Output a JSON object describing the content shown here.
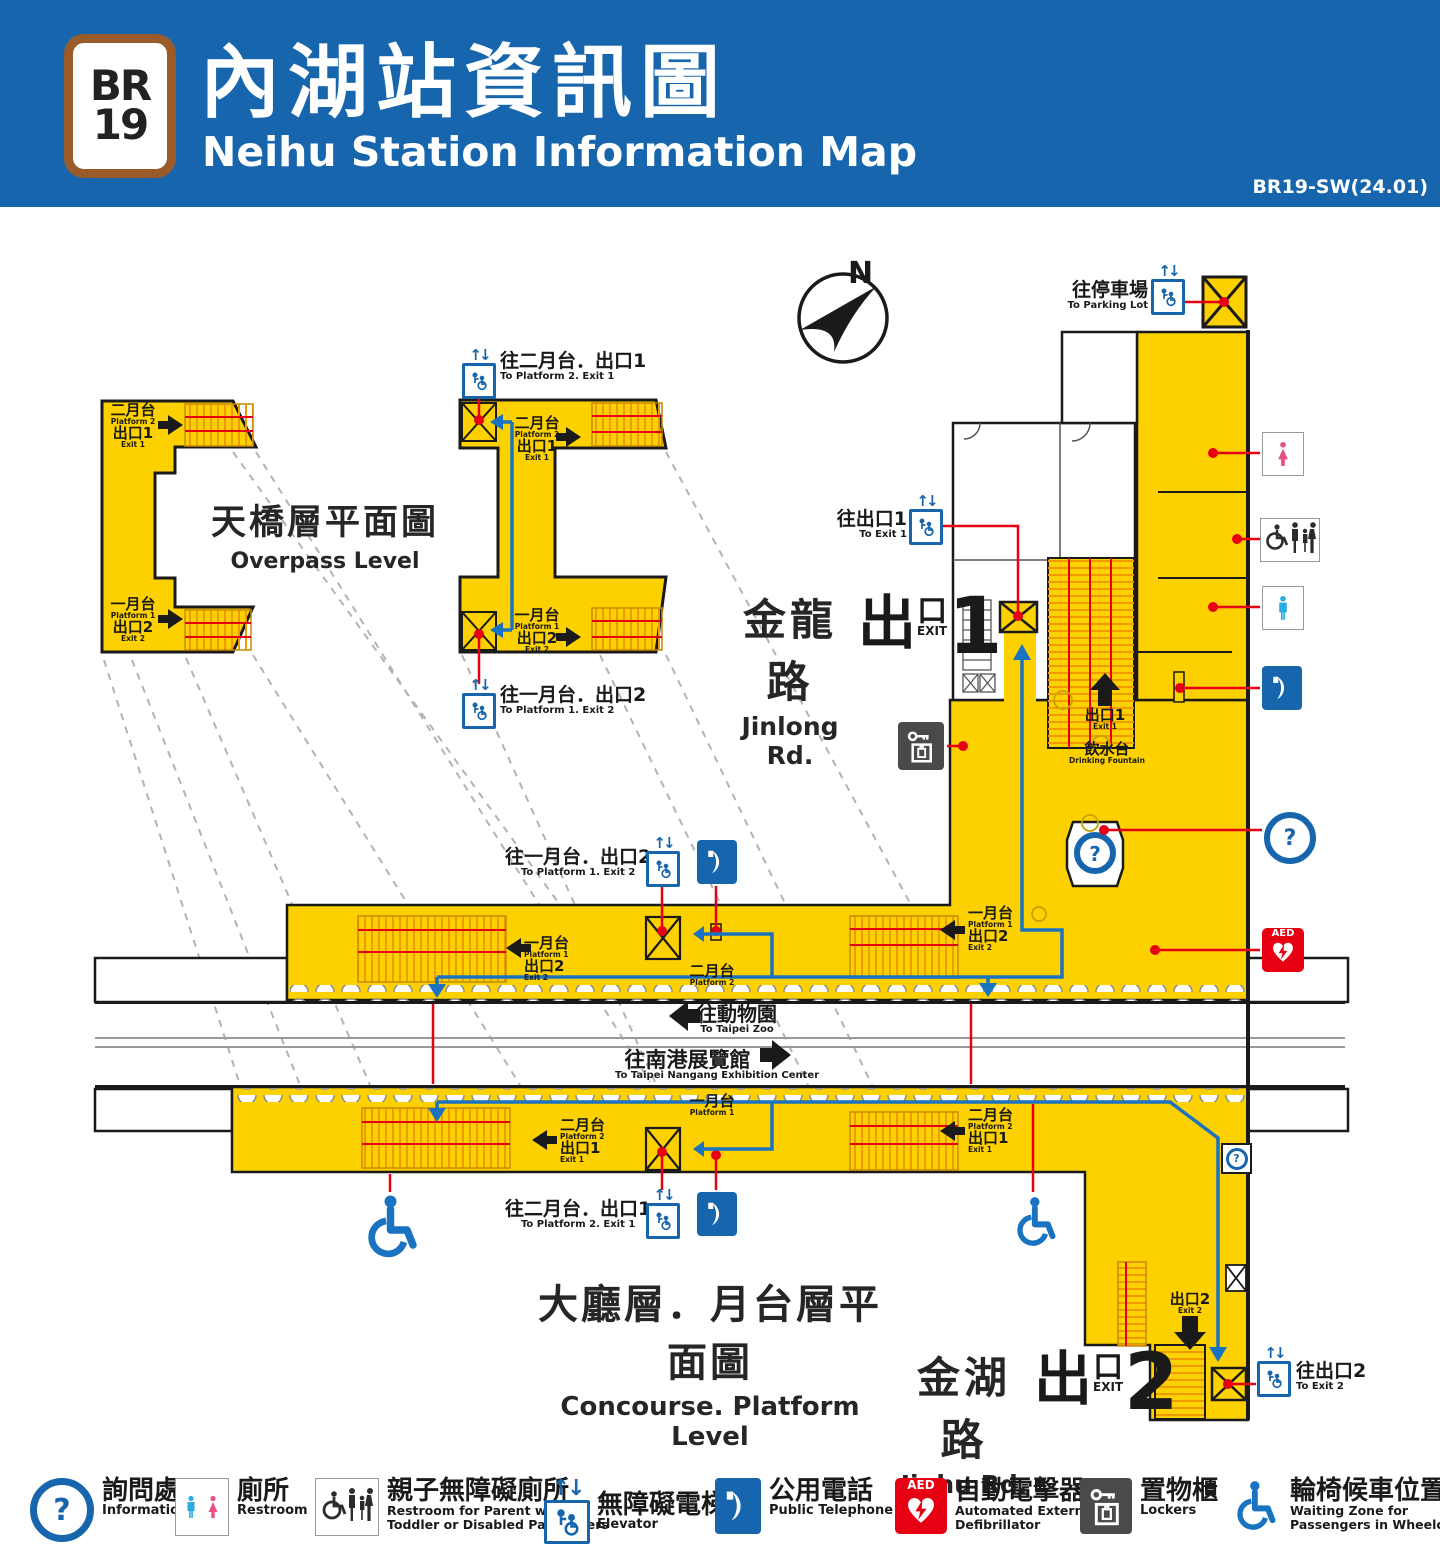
{
  "header": {
    "badge_line": "BR",
    "badge_num": "19",
    "title_zh": "內湖站資訊圖",
    "title_en": "Neihu Station Information Map",
    "version": "BR19-SW(24.01)"
  },
  "icons": {
    "question": "?",
    "updown": "↑↓",
    "aed": "AED",
    "compass_n": "N"
  },
  "levels": {
    "overpass_zh": "天橋層平面圖",
    "overpass_en": "Overpass Level",
    "concourse_zh": "大廳層．月台層平面圖",
    "concourse_en": "Concourse. Platform Level"
  },
  "roads": {
    "jinlong_zh": "金龍路",
    "jinlong_en": "Jinlong Rd.",
    "jinhu_zh": "金湖路",
    "jinhu_en": "Jinhu Rd."
  },
  "exits": {
    "chu": "出",
    "kou": "口",
    "exit": "EXIT",
    "n1": "1",
    "n2": "2"
  },
  "platform": {
    "p1_zh": "一月台",
    "p1_en": "Platform 1",
    "p2_zh": "二月台",
    "p2_en": "Platform 2",
    "e1_zh": "出口1",
    "e1_en": "Exit 1",
    "e2_zh": "出口2",
    "e2_en": "Exit 2"
  },
  "directions": {
    "to_p2e1_zh": "往二月台．出口1",
    "to_p2e1_en": "To Platform 2. Exit 1",
    "to_p1e2_zh": "往一月台．出口2",
    "to_p1e2_en": "To Platform 1. Exit 2",
    "to_exit1_zh": "往出口1",
    "to_exit1_en": "To Exit 1",
    "to_exit2_zh": "往出口2",
    "to_exit2_en": "To Exit 2",
    "to_parking_zh": "往停車場",
    "to_parking_en": "To Parking Lot",
    "to_zoo_zh": "往動物園",
    "to_zoo_en": "To Taipei Zoo",
    "to_nangang_zh": "往南港展覽館",
    "to_nangang_en": "To Taipei Nangang Exhibition Center",
    "fountain_zh": "飲水台",
    "fountain_en": "Drinking Fountain"
  },
  "legend": {
    "items": [
      {
        "zh": "詢問處",
        "en": "Information",
        "en2": ""
      },
      {
        "zh": "廁所",
        "en": "Restroom",
        "en2": ""
      },
      {
        "zh": "親子無障礙廁所",
        "en": "Restroom for Parent with",
        "en2": "Toddler or Disabled Passengers"
      },
      {
        "zh": "無障礙電梯",
        "en": "Elevator",
        "en2": ""
      },
      {
        "zh": "公用電話",
        "en": "Public Telephone",
        "en2": ""
      },
      {
        "zh": "自動電擊器",
        "en": "Automated External",
        "en2": "Defibrillator"
      },
      {
        "zh": "置物櫃",
        "en": "Lockers",
        "en2": ""
      },
      {
        "zh": "輪椅候車位置",
        "en": "Waiting Zone for",
        "en2": "Passengers in Wheelchairs"
      }
    ]
  }
}
